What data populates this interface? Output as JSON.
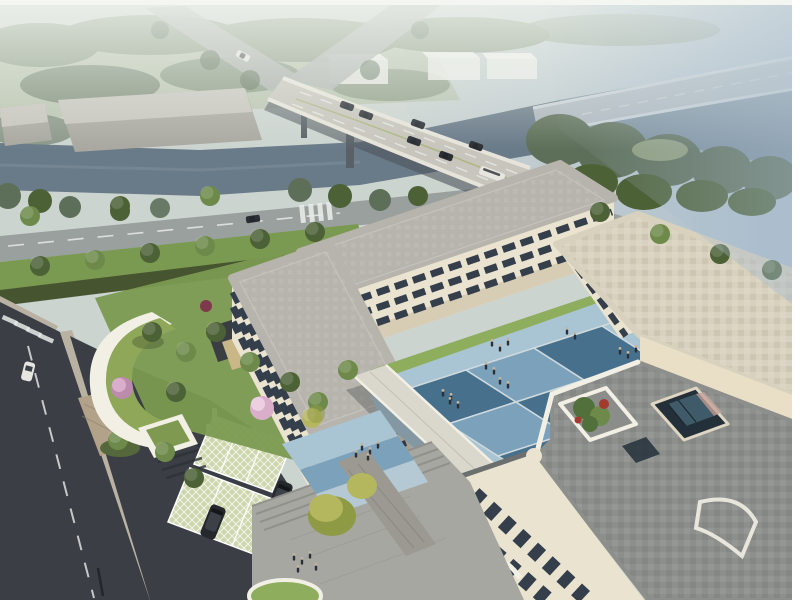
{
  "scene": {
    "title": "Aerial architectural rendering of a cream three-storey campus building complex with blue diamond-paved courtyard, green crescent roof, roof terrace with planter and skylight, riverside highway bridge with traffic, tree-lined streets, lattice-paver parking and pedestrians",
    "type": "architectural-rendering",
    "view": "aerial-perspective",
    "frame": {
      "top_border_px": 5,
      "right_border_px": 8
    }
  },
  "objects": {
    "bridge": {
      "label": "curved highway bridge over river",
      "vehicle_count": 7
    },
    "ramp": {
      "label": "distant elevated ramp in haze"
    },
    "river": {
      "label": "river flowing under bridge, hazy water to upper right"
    },
    "sheds": {
      "label": "two grey warehouse sheds upper left"
    },
    "distant_boxes": {
      "label": "three hazy white box buildings behind bridge"
    },
    "front_road": {
      "label": "tree-lined road along site with crosswalk",
      "red_cars": 2,
      "dark_cars": 1,
      "white_cars": 2
    },
    "west_street": {
      "label": "dark asphalt street lower left with dashed centerline",
      "white_cars": 1
    },
    "building": {
      "label": "U-shaped cream building, 3 floors, ribbon windows, rounded corners"
    },
    "courtyard": {
      "label": "blue diamond tile courtyard with pedestrians",
      "tile_rows": 3,
      "tile_cols": 4
    },
    "walkway": {
      "label": "white covered link walkway"
    },
    "terrace": {
      "label": "grey paver roof terrace with planter and glass atrium skylight"
    },
    "crescent_roof": {
      "label": "crescent-shaped green grass roof annex"
    },
    "parking": {
      "label": "grass-lattice parking stalls",
      "suv_count": 2
    },
    "plaza": {
      "label": "stepped plaza with blue paving bands and pedestrians"
    },
    "people_groups": 8,
    "blossom_trees": 4
  },
  "palette": {
    "sky_base": "#ccd4d0",
    "haze_white": "#eef2ec",
    "haze_blue": "#a9bccd",
    "forest_hazy": "#87977f",
    "forest_dark": "#5d6f58",
    "meadow": "#a5b28c",
    "water": "#697a88",
    "water_haze": "#8da2b2",
    "shed_grey": "#a9a8a0",
    "shed_light": "#c6c5bd",
    "box_white": "#eceee9",
    "bridge_deck": "#c7c5bc",
    "bridge_edge": "#e6e4da",
    "bridge_shadow": "#4d545b",
    "ramp_grey": "#b7bfc4",
    "road_grey": "#9aa09e",
    "road_light": "#aeb3af",
    "asphalt_dark": "#3b3f45",
    "lane_white": "#e8ebe8",
    "lane_yellow": "#c3a75f",
    "lane_green": "#9fae62",
    "hedge_dark": "#46552f",
    "lawn": "#7b9a51",
    "lawn_bright": "#8fae5d",
    "tree_green": "#6d8a4a",
    "tree_deep": "#4c6136",
    "tree_yellow": "#b5b75f",
    "tree_yellow_deep": "#8f9a45",
    "blossom": "#d9aecb",
    "blossom_deep": "#bc8bad",
    "lattice_green": "#cdd6ad",
    "paver_tan": "#b2a289",
    "plaza_grey": "#a7a7a2",
    "plaza_steps": "#8f8f8a",
    "path_brick": "#9b9992",
    "building_cream": "#eae3cf",
    "building_shadow": "#d6cdb4",
    "parapet_white": "#f2efe4",
    "wall_long": "#e8dfc6",
    "window_dark": "#343f4b",
    "glass_blue": "#9db8c8",
    "roof_grey": "#b6b4ac",
    "roof_tan": "#d8d1bd",
    "terrace_grey": "#8d8f8c",
    "terrace_dark": "#6e716f",
    "tile_dark": "#47708d",
    "tile_mid": "#7ca2bb",
    "tile_pale": "#a9c4d2",
    "tile_line": "#cfdade",
    "car_dark": "#2b2f34",
    "car_red": "#8e2921",
    "car_white": "#e6e5e0",
    "suv_dark": "#24272b",
    "person_dark": "#2c3036",
    "person_head": "#c3b49f",
    "green_roof": "#8fa758",
    "canopy_green": "#7f9a50",
    "sand_tan": "#c9b787",
    "planter_green": "#52703c",
    "planter_red": "#a23a2e",
    "atrium_dark": "#233039",
    "atrium_glass": "#3f5a68",
    "atrium_wall": "#c4a49b",
    "border_top": "#f3f6f1",
    "border_right": "#ffffff"
  }
}
